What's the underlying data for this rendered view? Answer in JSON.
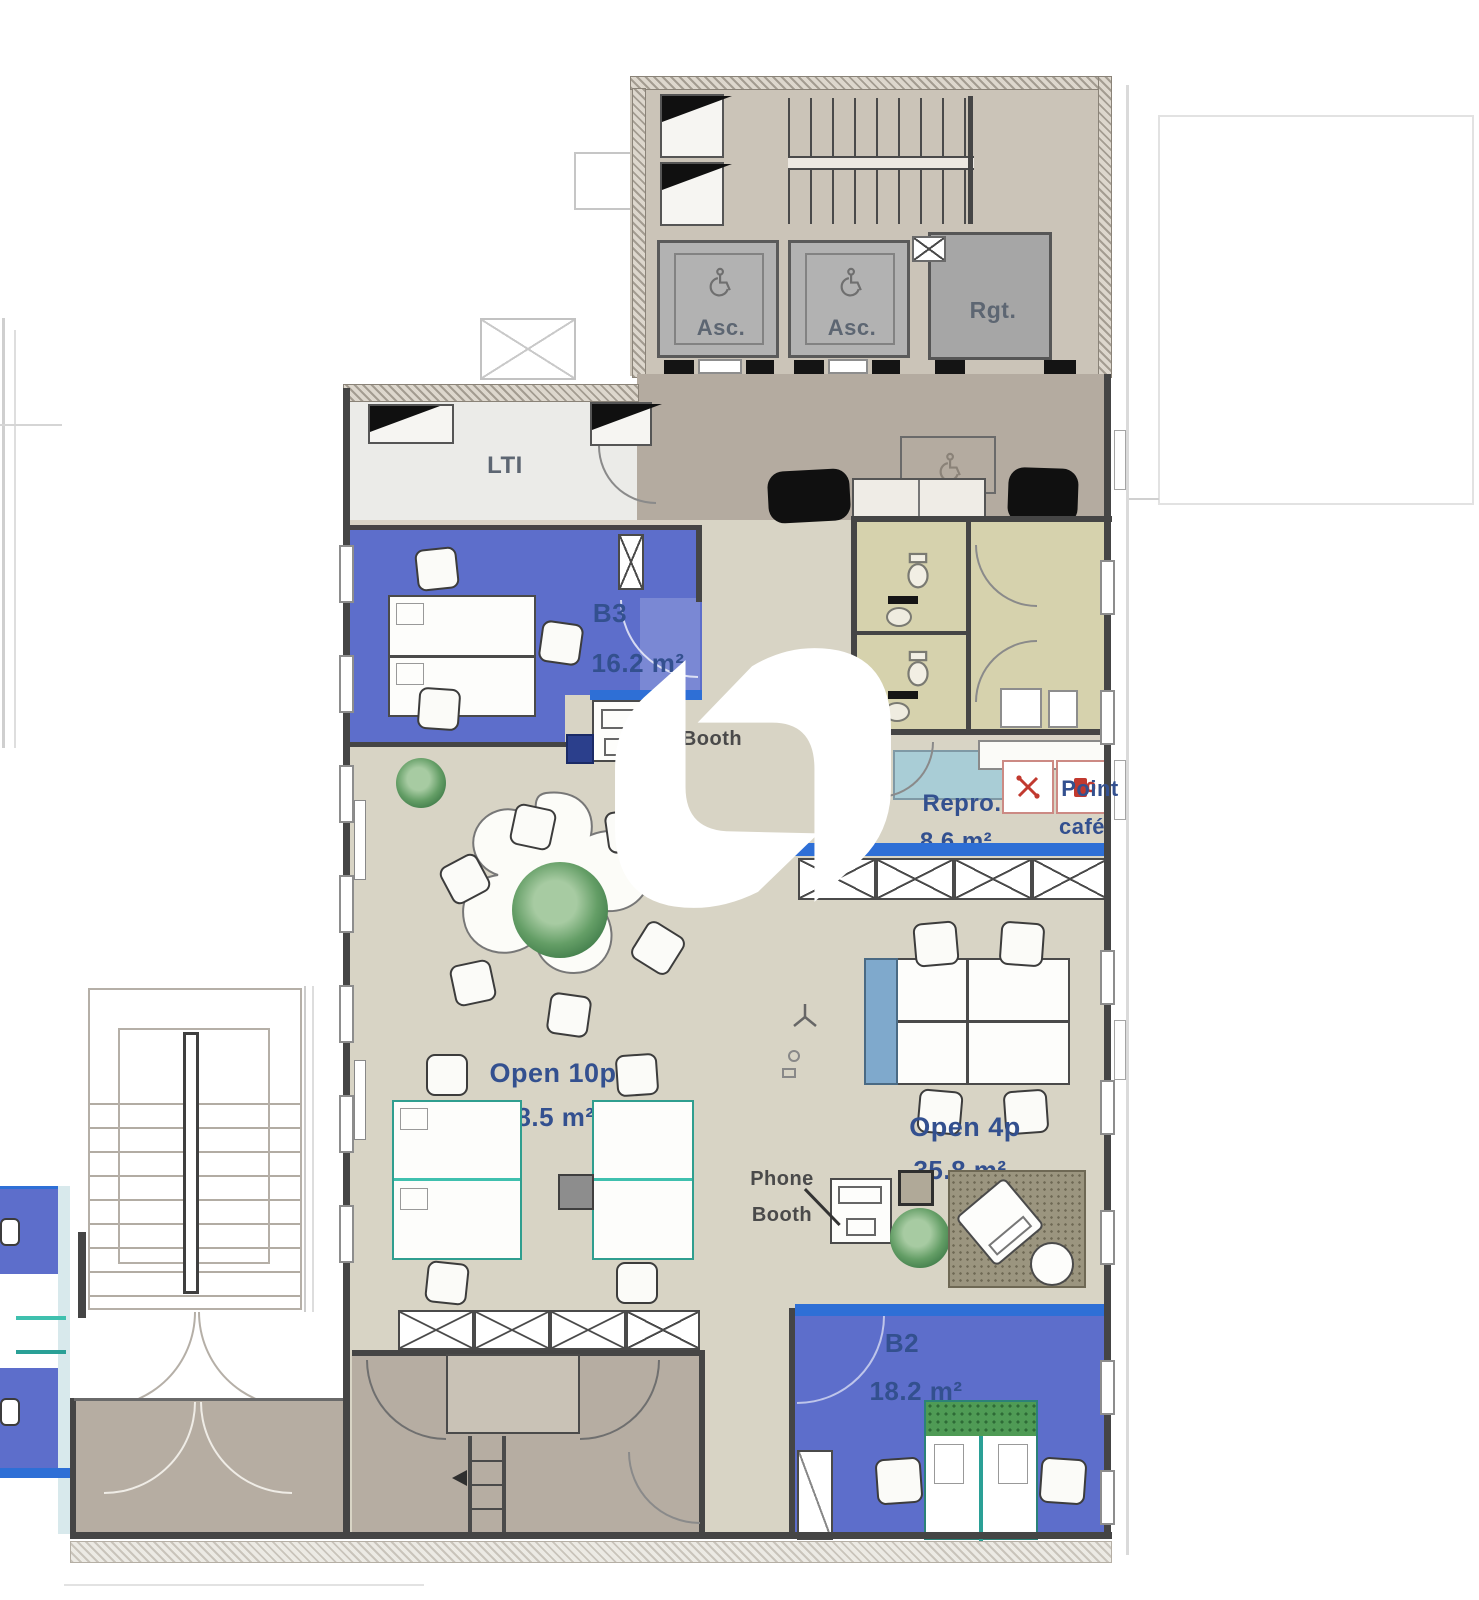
{
  "plan": {
    "core": {
      "elevator_label": "Asc.",
      "rgt_label": "Rgt."
    },
    "rooms": {
      "lti": {
        "label": "LTI"
      },
      "b3": {
        "label": "B3",
        "area": "16.2 m²"
      },
      "b3_booth": {
        "label": "Booth"
      },
      "repro": {
        "label": "Repro.",
        "area": "8.6 m²"
      },
      "point_cafe": {
        "line1": "Point",
        "line2": "café"
      },
      "open10": {
        "label": "Open 10p",
        "area": "48.5 m²"
      },
      "open4": {
        "label": "Open 4p",
        "area": "35.8 m²"
      },
      "phone_booth": {
        "line1": "Phone",
        "line2": "Booth"
      },
      "b2": {
        "label": "B2",
        "area": "18.2 m²"
      }
    },
    "colors": {
      "blue_room": "#5d6ecb",
      "highlight_blue": "#2e6fd6",
      "teal_accent": "#3fc0ae",
      "floor_beige": "#d8d4c5",
      "lobby_taupe": "#b4aba0",
      "wc_khaki": "#d6d2ad",
      "counter_blue": "#a9cdd6",
      "label_navy": "#33508f",
      "cafe_red": "#c1392f",
      "plant_green": "#4f9b55"
    }
  }
}
